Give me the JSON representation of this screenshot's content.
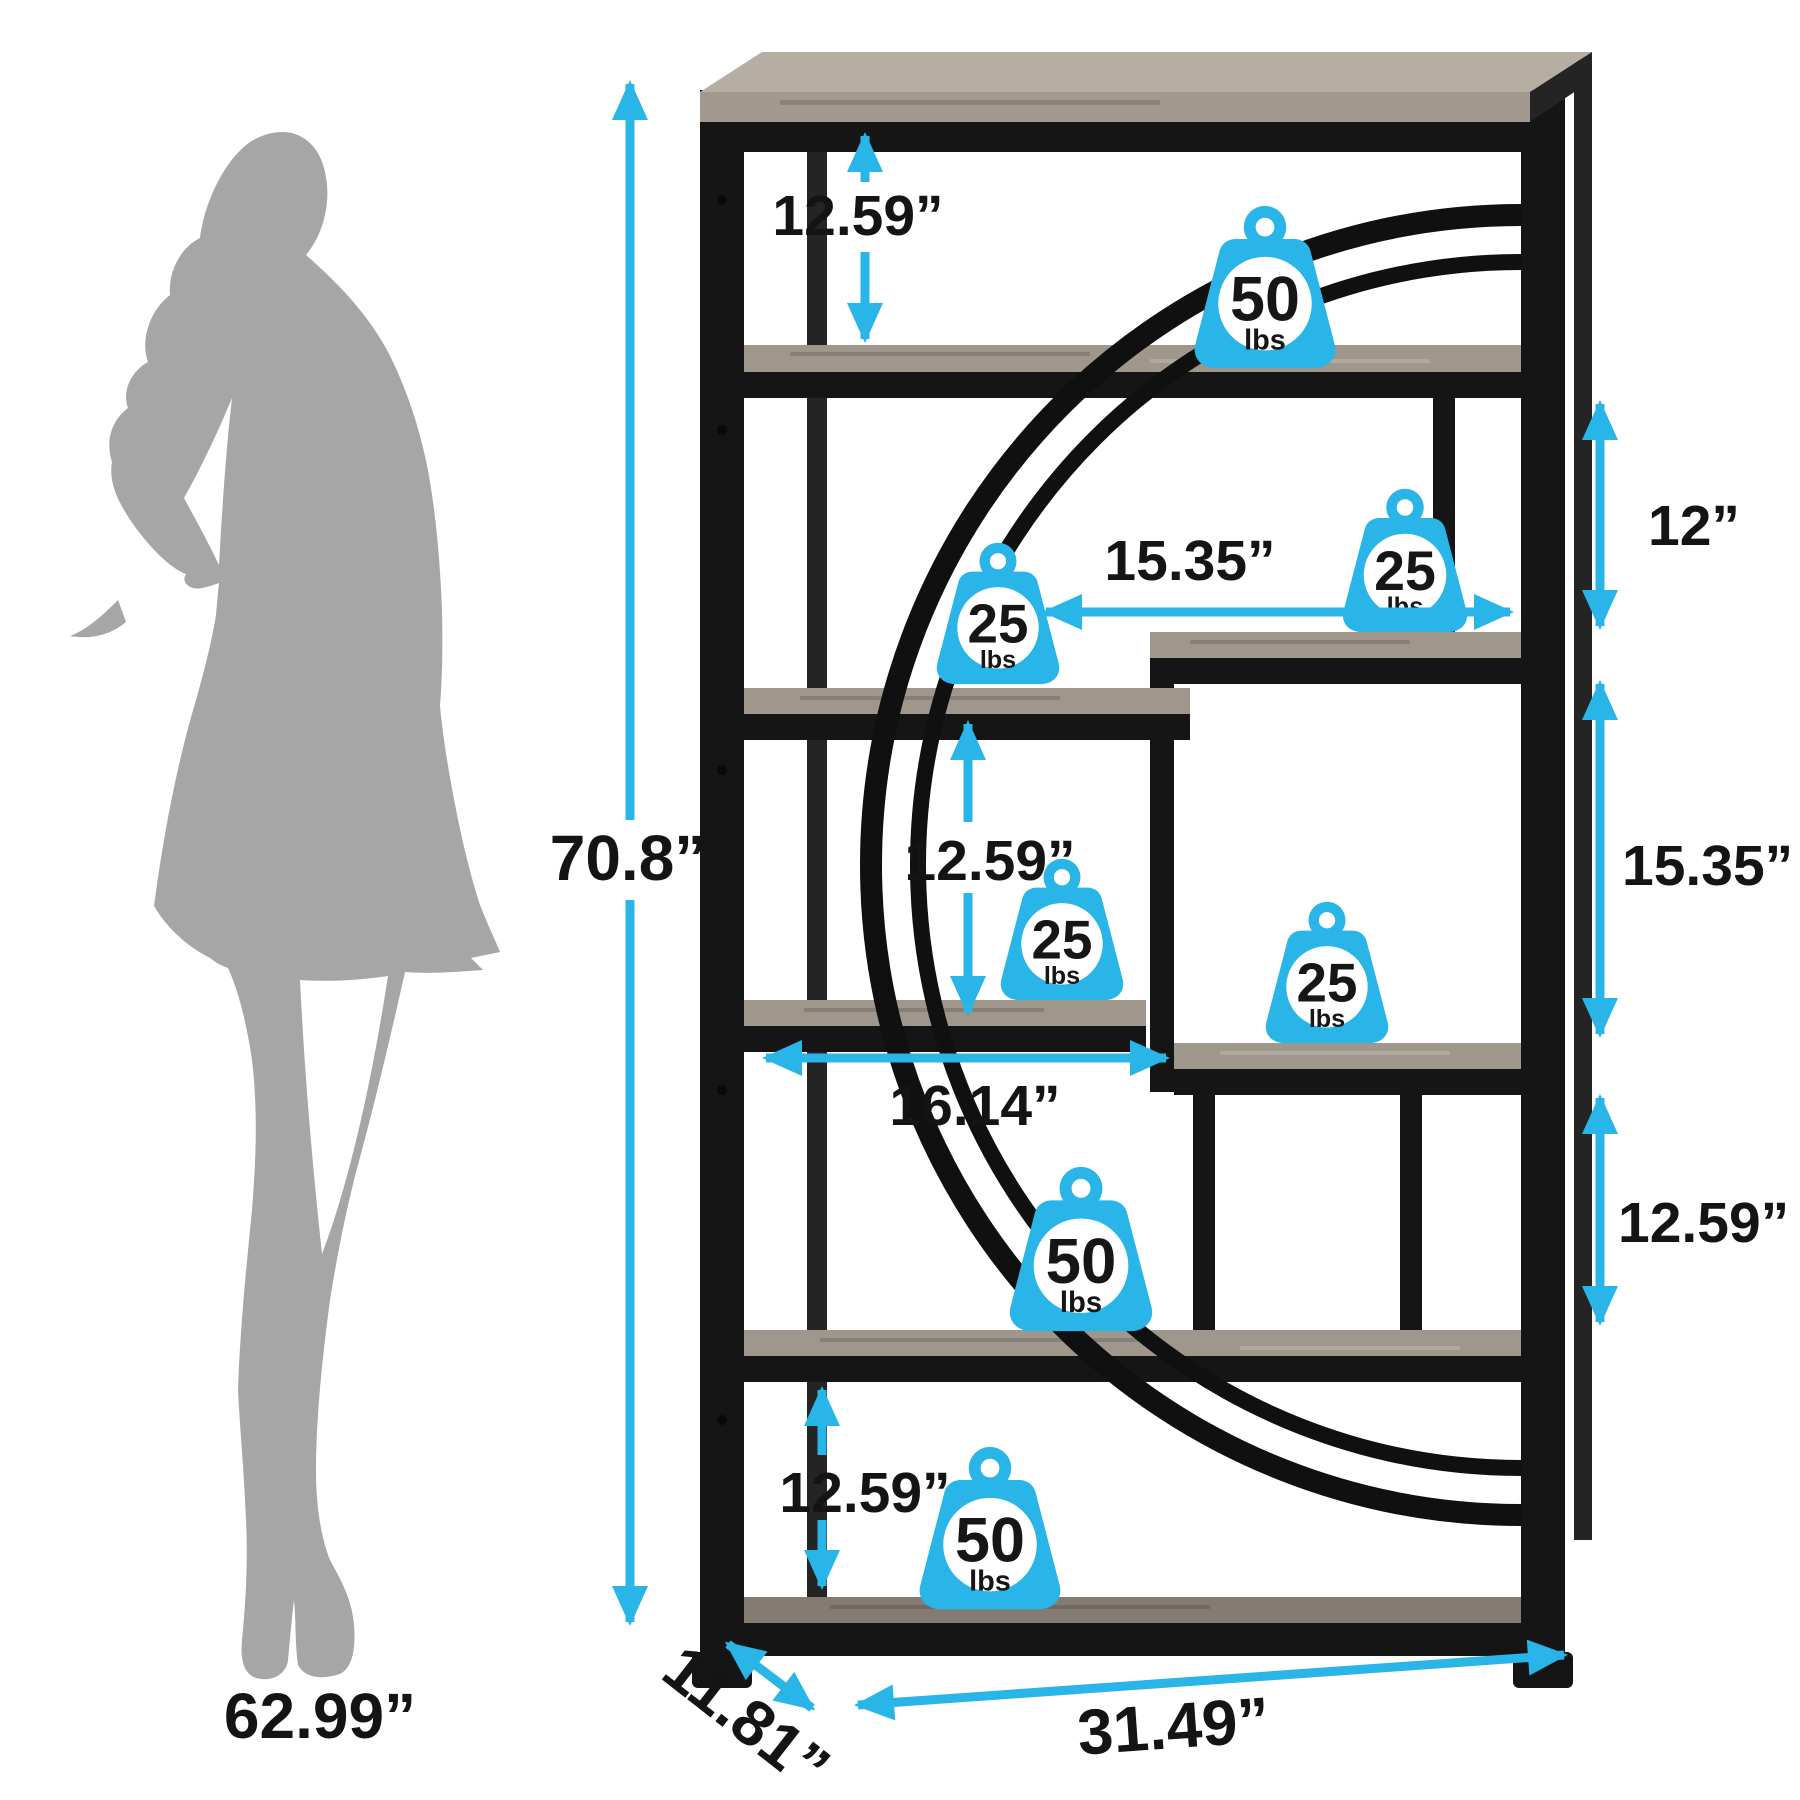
{
  "diagram": {
    "description": "Bookshelf dimension diagram with woman silhouette for scale",
    "person": {
      "height_label": "62.99”"
    },
    "overall": {
      "height": "70.8”",
      "width": "31.49”",
      "depth": "11.81”"
    },
    "dims": {
      "top_gap": "12.59”",
      "right_top_gap": "12”",
      "right_shelf_width": "15.35”",
      "right_mid_gap": "15.35”",
      "right_lower_gap": "12.59”",
      "mid_gap": "12.59”",
      "left_shelf_width": "16.14”",
      "bottom_gap": "12.59”"
    },
    "weights": [
      {
        "value": "50",
        "unit": "lbs"
      },
      {
        "value": "25",
        "unit": "lbs"
      },
      {
        "value": "25",
        "unit": "lbs"
      },
      {
        "value": "25",
        "unit": "lbs"
      },
      {
        "value": "25",
        "unit": "lbs"
      },
      {
        "value": "50",
        "unit": "lbs"
      },
      {
        "value": "50",
        "unit": "lbs"
      }
    ],
    "colors": {
      "accent": "#29b5e8",
      "silhouette": "#a6a6a6",
      "frame": "#151515",
      "wood": "#9f968c",
      "text": "#141414"
    }
  }
}
